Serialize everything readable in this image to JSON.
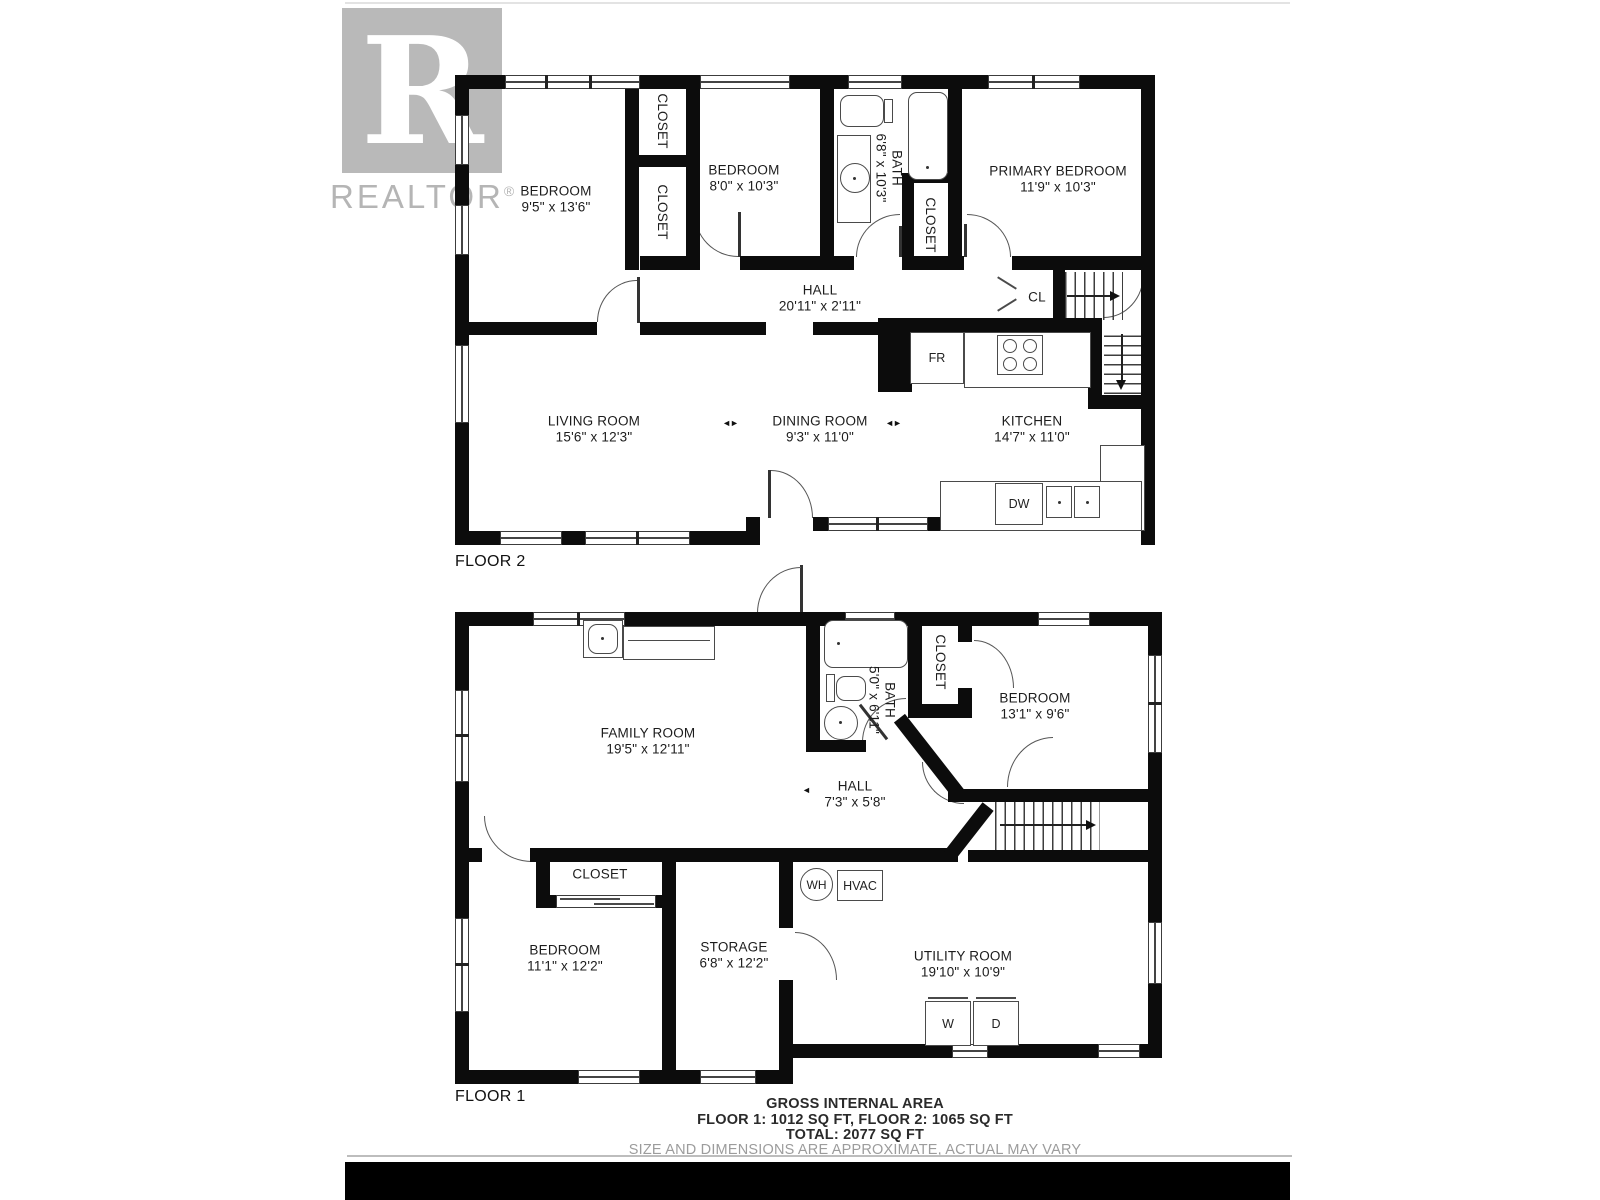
{
  "watermark": {
    "logo_letter": "R",
    "brand": "REALTOR",
    "registered": "®"
  },
  "symbols": {
    "opening_marker": "◄►",
    "pointer_left": "◄"
  },
  "floor2": {
    "label": "FLOOR 2",
    "bedroom1": {
      "name": "BEDROOM",
      "dims": "9'5\" x 13'6\""
    },
    "closet_top": {
      "name": "CLOSET"
    },
    "closet_mid": {
      "name": "CLOSET"
    },
    "bedroom2": {
      "name": "BEDROOM",
      "dims": "8'0\" x 10'3\""
    },
    "bath": {
      "name": "BATH",
      "dims": "6'8\" x 10'3\""
    },
    "bath_closet": {
      "name": "CLOSET"
    },
    "primary": {
      "name": "PRIMARY BEDROOM",
      "dims": "11'9\" x 10'3\""
    },
    "hall": {
      "name": "HALL",
      "dims": "20'11\" x 2'11\""
    },
    "cl": {
      "name": "CL"
    },
    "fridge": {
      "name": "FR"
    },
    "living": {
      "name": "LIVING ROOM",
      "dims": "15'6\" x 12'3\""
    },
    "dining": {
      "name": "DINING ROOM",
      "dims": "9'3\" x 11'0\""
    },
    "kitchen": {
      "name": "KITCHEN",
      "dims": "14'7\" x 11'0\""
    },
    "dishwasher": {
      "name": "DW"
    }
  },
  "floor1": {
    "label": "FLOOR 1",
    "family": {
      "name": "FAMILY ROOM",
      "dims": "19'5\" x 12'11\""
    },
    "bath": {
      "name": "BATH",
      "dims": "5'0\" x 6'11\""
    },
    "closet_right": {
      "name": "CLOSET"
    },
    "bedroom_right": {
      "name": "BEDROOM",
      "dims": "13'1\" x 9'6\""
    },
    "hall": {
      "name": "HALL",
      "dims": "7'3\" x 5'8\""
    },
    "closet_left": {
      "name": "CLOSET"
    },
    "water_heater": {
      "name": "WH"
    },
    "hvac": {
      "name": "HVAC"
    },
    "bedroom_left": {
      "name": "BEDROOM",
      "dims": "11'1\" x 12'2\""
    },
    "storage": {
      "name": "STORAGE",
      "dims": "6'8\" x 12'2\""
    },
    "utility": {
      "name": "UTILITY ROOM",
      "dims": "19'10\" x 10'9\""
    },
    "washer": {
      "name": "W"
    },
    "dryer": {
      "name": "D"
    }
  },
  "footer": {
    "line1": "GROSS INTERNAL AREA",
    "line2": "FLOOR 1: 1012 SQ FT, FLOOR 2: 1065 SQ FT",
    "line3": "TOTAL: 2077 SQ FT",
    "line4": "SIZE AND DIMENSIONS ARE APPROXIMATE, ACTUAL MAY VARY"
  }
}
